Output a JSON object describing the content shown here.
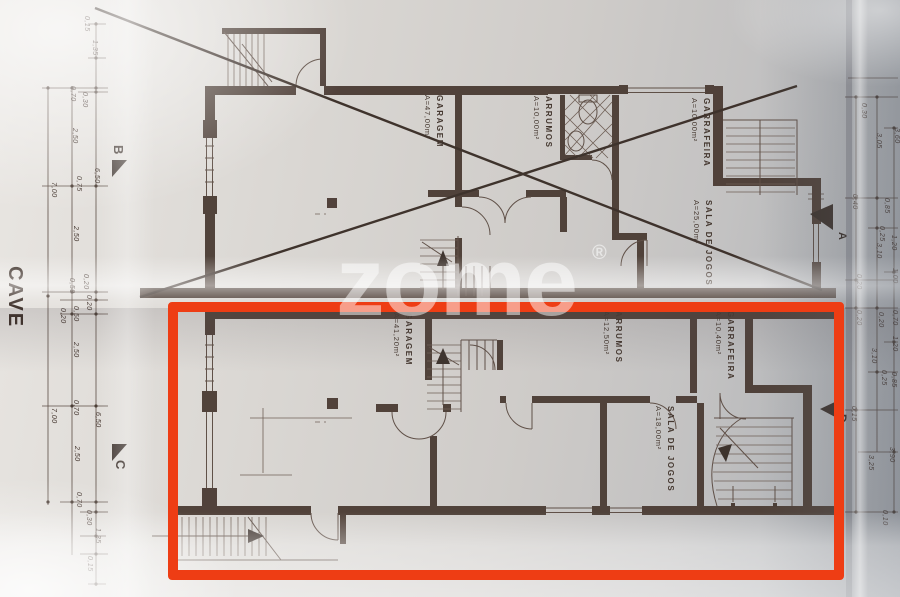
{
  "plan": {
    "title": "CAVE",
    "units": [
      {
        "id": "upper-unit",
        "rooms": [
          {
            "name": "GARAGEM",
            "area": "A=47,00m²"
          },
          {
            "name": "ARRUMOS",
            "area": "A=10,00m²"
          },
          {
            "name": "GARRAFEIRA",
            "area": "A=10,00m²"
          },
          {
            "name": "SALA DE JOGOS",
            "area": "A=25,00m²"
          }
        ]
      },
      {
        "id": "lower-unit",
        "rooms": [
          {
            "name": "GARAGEM",
            "area": "A=41,20m²"
          },
          {
            "name": "ARRUMOS",
            "area": "A=12,50m²"
          },
          {
            "name": "GARRAFEIRA",
            "area": "A=10,40m²"
          },
          {
            "name": "SALA DE JOGOS",
            "area": "A=18,00m²"
          }
        ]
      }
    ],
    "markers": {
      "a": "A",
      "b": "B",
      "c": "C",
      "d": "D"
    },
    "dims_left": [
      "0,15",
      "1,35",
      "0,70",
      "0,30",
      "2,50",
      "0,75",
      "6,50",
      "7,00",
      "2,50",
      "0,20",
      "0,50",
      "0,20",
      "0,50",
      "0,20",
      "2,50",
      "0,70",
      "6,50",
      "7,00",
      "2,50",
      "0,70",
      "0,30",
      "1,35",
      "0,15"
    ],
    "dims_right": [
      "0,30",
      "3,05",
      "3,60",
      "0,40",
      "0,85",
      "0,25",
      "1,20",
      "3,10",
      "1,00",
      "0,20",
      "0,70",
      "0,20",
      "0,20",
      "1,20",
      "3,10",
      "0,25",
      "0,85",
      "0,15",
      "3,25",
      "3,90",
      "0,10"
    ]
  },
  "watermark": {
    "text": "zome",
    "reg": "®"
  }
}
